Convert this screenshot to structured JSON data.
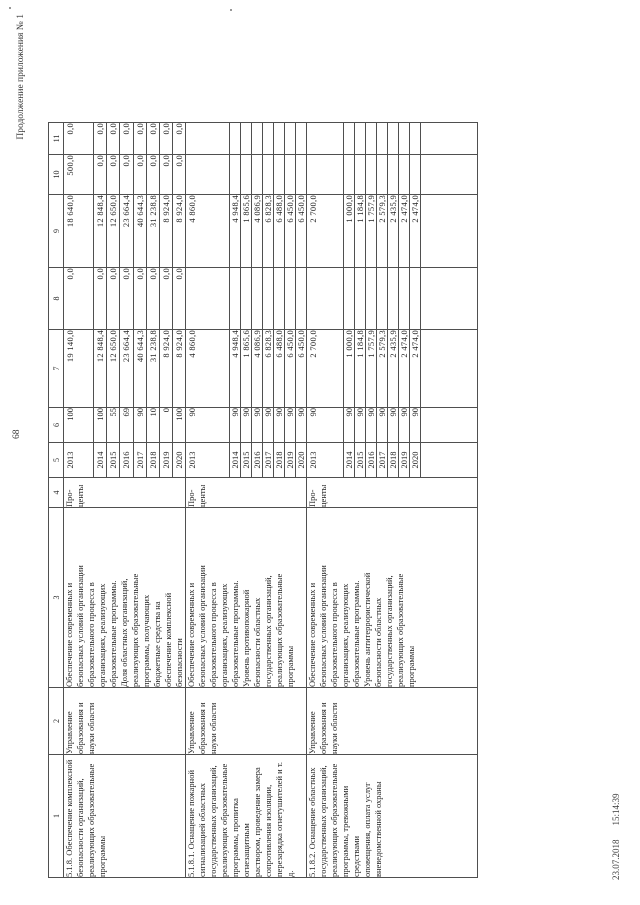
{
  "page": {
    "appendix_note": "Продолжение приложения № 1",
    "page_number": "68",
    "print_date": "23.07.2018",
    "print_time": "15:14:39"
  },
  "table": {
    "col_headers": [
      "1",
      "2",
      "3",
      "4",
      "5",
      "6",
      "7",
      "8",
      "9",
      "10",
      "11"
    ],
    "groups": [
      {
        "item": "5.1.8. Обеспечение комплексной\nбезопасности организаций,\nреализующих образовательные\nпрограммы",
        "executor": "Управление\nобразования и\nнауки области",
        "indicator": "Обеспечение современных и\nбезопасных условий организации\nобразовательного процесса в\nорганизациях, реализующих\nобразовательные программы.\nДоля областных организаций,\nреализующих образовательные\nпрограммы, получающих\nбюджетные средства на\nобеспечение комплексной\nбезопасности",
        "unit": "Про-\nценты",
        "rows": [
          {
            "year": "2013",
            "percent": "100",
            "c7": "19 140,0",
            "c8": "0,0",
            "c9": "18 640,0",
            "c10": "500,0",
            "c11": "0,0"
          },
          {
            "year": "2014",
            "percent": "100",
            "c7": "12 848,4",
            "c8": "0,0",
            "c9": "12 848,4",
            "c10": "0,0",
            "c11": "0,0"
          },
          {
            "year": "2015",
            "percent": "55",
            "c7": "12 650,0",
            "c8": "0,0",
            "c9": "12 650,0",
            "c10": "0,0",
            "c11": "0,0"
          },
          {
            "year": "2016",
            "percent": "69",
            "c7": "23 664,4",
            "c8": "0,0",
            "c9": "23 664,4",
            "c10": "0,0",
            "c11": "0,0"
          },
          {
            "year": "2017",
            "percent": "90",
            "c7": "40 644,3",
            "c8": "0,0",
            "c9": "40 644,3",
            "c10": "0,0",
            "c11": "0,0"
          },
          {
            "year": "2018",
            "percent": "10",
            "c7": "31 238,8",
            "c8": "0,0",
            "c9": "31 238,8",
            "c10": "0,0",
            "c11": "0,0"
          },
          {
            "year": "2019",
            "percent": "0",
            "c7": "8 924,0",
            "c8": "0,0",
            "c9": "8 924,0",
            "c10": "0,0",
            "c11": "0,0"
          },
          {
            "year": "2020",
            "percent": "100",
            "c7": "8 924,0",
            "c8": "0,0",
            "c9": "8 924,0",
            "c10": "0,0",
            "c11": "0,0"
          }
        ]
      },
      {
        "item": "5.1.8.1. Оснащение пожарной\nсигнализацией областных\nгосударственных организаций,\nреализующих образовательные\nпрограммы, пропитка огнезащитным\nраствором, проведение замера\nсопротивления изоляции,\nперезарядка огнетушителей и т. д.",
        "executor": "Управление\nобразования и\nнауки области",
        "indicator": "Обеспечение современных и\nбезопасных условий организации\nобразовательного процесса в\nорганизациях, реализующих\nобразовательные программы.\nУровень противопожарной\nбезопасности областных\nгосударственных организаций,\nреализующих образовательные\nпрограммы",
        "unit": "Про-\nценты",
        "rows": [
          {
            "year": "2013",
            "percent": "90",
            "c7": "4 860,0",
            "c8": "",
            "c9": "4 860,0",
            "c10": "",
            "c11": ""
          },
          {
            "year": "2014",
            "percent": "90",
            "c7": "4 948,4",
            "c8": "",
            "c9": "4 948,4",
            "c10": "",
            "c11": ""
          },
          {
            "year": "2015",
            "percent": "90",
            "c7": "1 865,6",
            "c8": "",
            "c9": "1 865,6",
            "c10": "",
            "c11": ""
          },
          {
            "year": "2016",
            "percent": "90",
            "c7": "4 086,9",
            "c8": "",
            "c9": "4 086,9",
            "c10": "",
            "c11": ""
          },
          {
            "year": "2017",
            "percent": "90",
            "c7": "6 828,3",
            "c8": "",
            "c9": "6 828,3",
            "c10": "",
            "c11": ""
          },
          {
            "year": "2018",
            "percent": "90",
            "c7": "6 488,0",
            "c8": "",
            "c9": "6 488,0",
            "c10": "",
            "c11": ""
          },
          {
            "year": "2019",
            "percent": "90",
            "c7": "6 450,0",
            "c8": "",
            "c9": "6 450,0",
            "c10": "",
            "c11": ""
          },
          {
            "year": "2020",
            "percent": "90",
            "c7": "6 450,0",
            "c8": "",
            "c9": "6 450,0",
            "c10": "",
            "c11": ""
          }
        ]
      },
      {
        "item": "5.1.8.2. Оснащение областных\nгосударственных организаций,\nреализующих образовательные\nпрограммы, тревожными средствами\nоповещения, оплата услуг\nвневедомственной охраны",
        "executor": "Управление\nобразования и\nнауки области",
        "indicator": "Обеспечение современных и\nбезопасных условий организации\nобразовательного процесса в\nорганизациях, реализующих\nобразовательные программы.\nУровень антитеррористической\nбезопасности областных\nгосударственных организаций,\nреализующих образовательные\nпрограммы",
        "unit": "Про-\nценты",
        "rows": [
          {
            "year": "2013",
            "percent": "90",
            "c7": "2 700,0",
            "c8": "",
            "c9": "2 700,0",
            "c10": "",
            "c11": ""
          },
          {
            "year": "2014",
            "percent": "90",
            "c7": "1 000,0",
            "c8": "",
            "c9": "1 000,0",
            "c10": "",
            "c11": ""
          },
          {
            "year": "2015",
            "percent": "90",
            "c7": "1 184,8",
            "c8": "",
            "c9": "1 184,8",
            "c10": "",
            "c11": ""
          },
          {
            "year": "2016",
            "percent": "90",
            "c7": "1 757,9",
            "c8": "",
            "c9": "1 757,9",
            "c10": "",
            "c11": ""
          },
          {
            "year": "2017",
            "percent": "90",
            "c7": "2 579,3",
            "c8": "",
            "c9": "2 579,3",
            "c10": "",
            "c11": ""
          },
          {
            "year": "2018",
            "percent": "90",
            "c7": "2 435,9",
            "c8": "",
            "c9": "2 435,9",
            "c10": "",
            "c11": ""
          },
          {
            "year": "2019",
            "percent": "90",
            "c7": "2 474,0",
            "c8": "",
            "c9": "2 474,0",
            "c10": "",
            "c11": ""
          },
          {
            "year": "2020",
            "percent": "90",
            "c7": "2 474,0",
            "c8": "",
            "c9": "2 474,0",
            "c10": "",
            "c11": ""
          }
        ]
      }
    ]
  }
}
